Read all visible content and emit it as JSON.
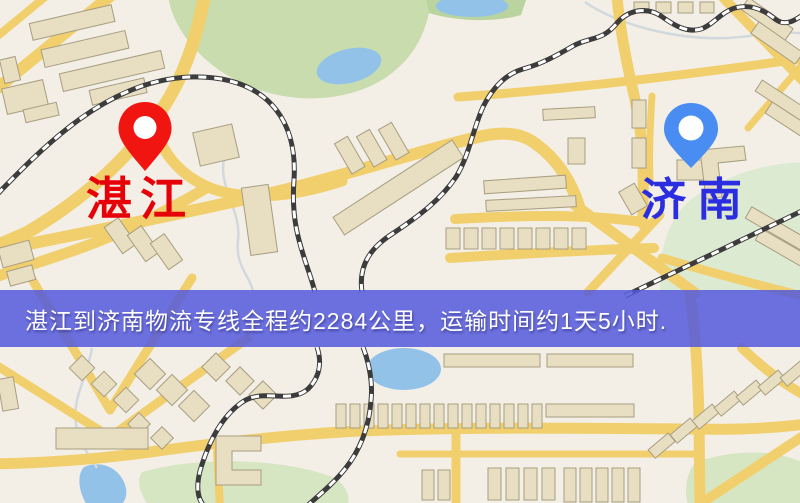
{
  "map": {
    "origin": {
      "name": "湛江",
      "pin_color": "#f01511",
      "label_color": "#e60008"
    },
    "destination": {
      "name": "济南",
      "pin_color": "#4a8df2",
      "label_color": "#2b2de0"
    },
    "banner": {
      "text": "湛江到济南物流专线全程约2284公里，运输时间约1天5小时.",
      "background_color": "#5359db",
      "text_color": "#ffffff",
      "distance_km": "2284",
      "duration": "1天5小时"
    },
    "palette": {
      "map_background": "#f3efe6",
      "road": "#f1cf6d",
      "park": "#c8dcae",
      "water": "#92c2e8",
      "building": "#e8dfc3",
      "railway": "#3c3c3c"
    }
  }
}
